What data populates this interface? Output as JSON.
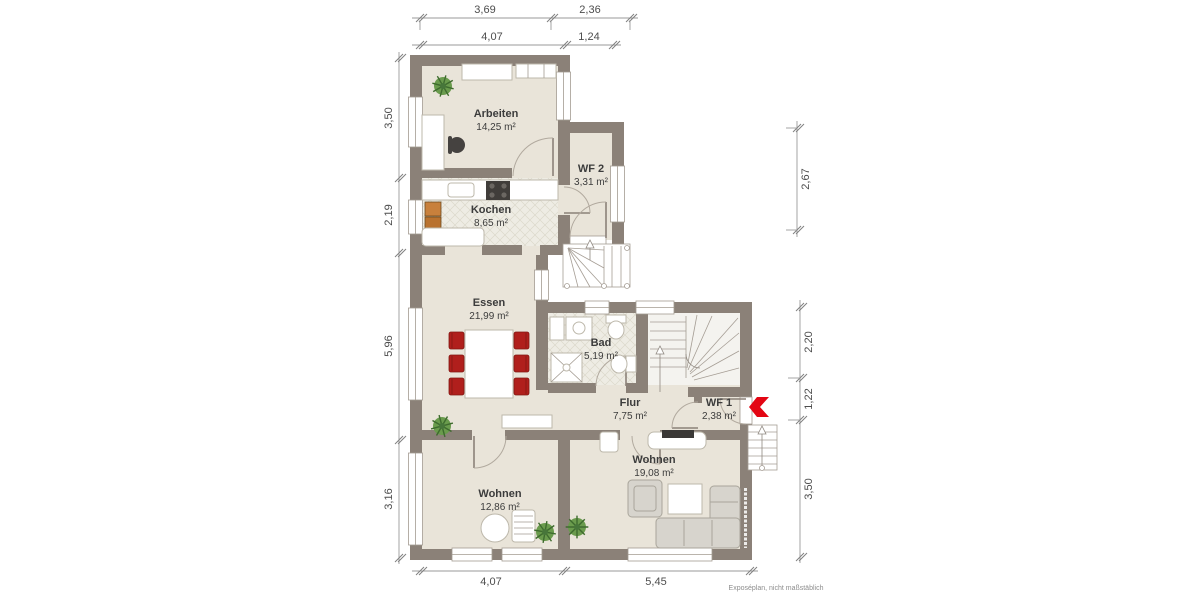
{
  "footer_note": "Exposéplan, nicht maßstäblich",
  "rooms": {
    "arbeiten": {
      "name": "Arbeiten",
      "area": "14,25 m²"
    },
    "wf2": {
      "name": "WF 2",
      "area": "3,31 m²"
    },
    "kochen": {
      "name": "Kochen",
      "area": "8,65 m²"
    },
    "essen": {
      "name": "Essen",
      "area": "21,99 m²"
    },
    "bad": {
      "name": "Bad",
      "area": "5,19 m²"
    },
    "flur": {
      "name": "Flur",
      "area": "7,75 m²"
    },
    "wf1": {
      "name": "WF 1",
      "area": "2,38 m²"
    },
    "wohnen_gross": {
      "name": "Wohnen",
      "area": "19,08 m²"
    },
    "wohnen_klein": {
      "name": "Wohnen",
      "area": "12,86 m²"
    }
  },
  "dimensions": {
    "top_outer": [
      "3,69",
      "2,36"
    ],
    "top_inner": [
      "4,07",
      "1,24"
    ],
    "left": [
      "3,50",
      "2,19",
      "5,96",
      "3,16"
    ],
    "right_upper": [
      "2,67"
    ],
    "right_lower": [
      "2,20",
      "1,22",
      "3,50"
    ],
    "bottom": [
      "4,07",
      "5,45"
    ]
  },
  "colors": {
    "wall": "#8b8178",
    "floor": "#e9e4d9",
    "tile_floor": "#eeece4",
    "entry_arrow_red": "#e30613",
    "chair_red": "#b01f1c",
    "plant_green": "#6a9b4d",
    "dimension_text": "#4d4d4d"
  }
}
